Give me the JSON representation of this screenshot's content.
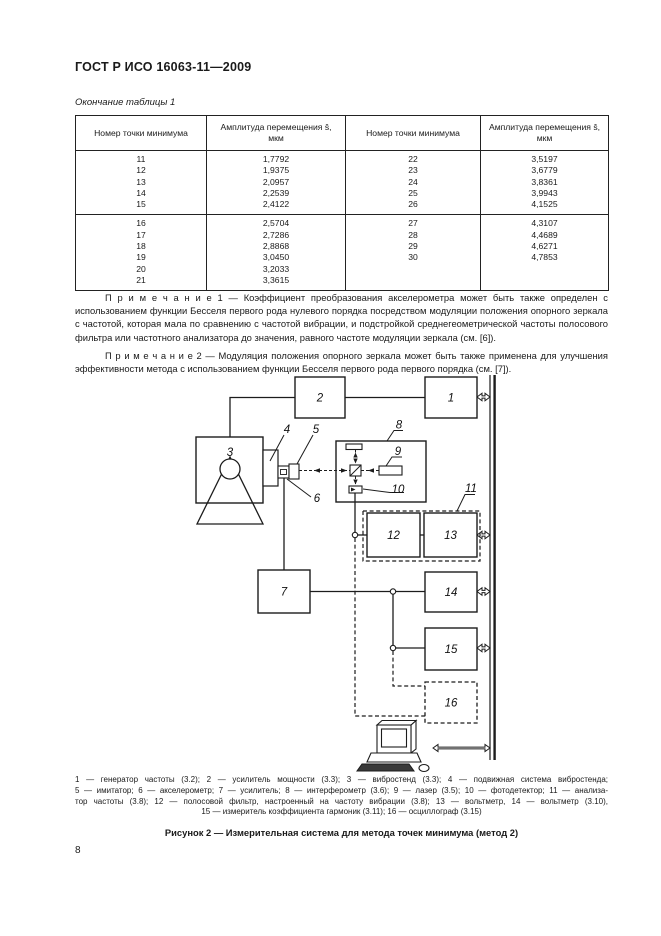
{
  "page": {
    "doc_code": "ГОСТ Р ИСО 16063-11—2009",
    "table_continuation": "Окончание таблицы 1",
    "page_number": "8"
  },
  "table": {
    "columns": [
      {
        "title": "Номер точки минимума",
        "sub": ""
      },
      {
        "title": "Амплитуда перемещения ŝ,",
        "sub": "мкм"
      },
      {
        "title": "Номер точки минимума",
        "sub": ""
      },
      {
        "title": "Амплитуда перемещения ŝ,",
        "sub": "мкм"
      }
    ],
    "groups": [
      {
        "rows": [
          [
            "11",
            "1,7792",
            "22",
            "3,5197"
          ],
          [
            "12",
            "1,9375",
            "23",
            "3,6779"
          ],
          [
            "13",
            "2,0957",
            "24",
            "3,8361"
          ],
          [
            "14",
            "2,2539",
            "25",
            "3,9943"
          ],
          [
            "15",
            "2,4122",
            "26",
            "4,1525"
          ]
        ]
      },
      {
        "rows": [
          [
            "16",
            "2,5704",
            "27",
            "4,3107"
          ],
          [
            "17",
            "2,7286",
            "28",
            "4,4689"
          ],
          [
            "18",
            "2,8868",
            "29",
            "4,6271"
          ],
          [
            "19",
            "3,0450",
            "30",
            "4,7853"
          ],
          [
            "20",
            "3,2033",
            "",
            ""
          ],
          [
            "21",
            "3,3615",
            "",
            ""
          ]
        ]
      }
    ]
  },
  "notes": [
    "П р и м е ч а н и е  1 — Коэффициент преобразования акселерометра может быть также определен с использованием функции Бесселя первого рода нулевого порядка посредством модуляции положения опорного зеркала с частотой, которая мала по сравнению с частотой вибрации, и подстройкой среднегеометрической частоты полосового фильтра или частотного анализатора до значения, равного частоте модуляции зеркала (см. [6]).",
    "П р и м е ч а н и е  2 — Модуляция положения опорного зеркала может быть также применена для улучшения эффективности метода с использованием функции Бесселя первого рода первого порядка (см. [7])."
  ],
  "diagram": {
    "labels": {
      "n1": "1",
      "n2": "2",
      "n3": "3",
      "n4": "4",
      "n5": "5",
      "n6": "6",
      "n7": "7",
      "n8": "8",
      "n9": "9",
      "n10": "10",
      "n11": "11",
      "n12": "12",
      "n13": "13",
      "n14": "14",
      "n15": "15",
      "n16": "16"
    }
  },
  "figure": {
    "legend_lines": [
      "1 — генератор частоты (3.2); 2 — усилитель мощности (3.3); 3 — вибростенд (3.3); 4 — подвижная система вибростенда;",
      "5 — имитатор; 6 — акселерометр; 7 — усилитель; 8 — интерферометр (3.6); 9 — лазер (3.5); 10 — фотодетектор; 11 — анализа-",
      "тор частоты (3.8); 12 — полосовой фильтр, настроенный на частоту вибрации (3.8); 13 — вольтметр, 14 — вольтметр (3.10),",
      "15 — измеритель коэффициента гармоник (3.11); 16 — осциллограф (3.15)"
    ],
    "caption": "Рисунок 2 — Измерительная система для метода точек минимума (метод 2)"
  }
}
